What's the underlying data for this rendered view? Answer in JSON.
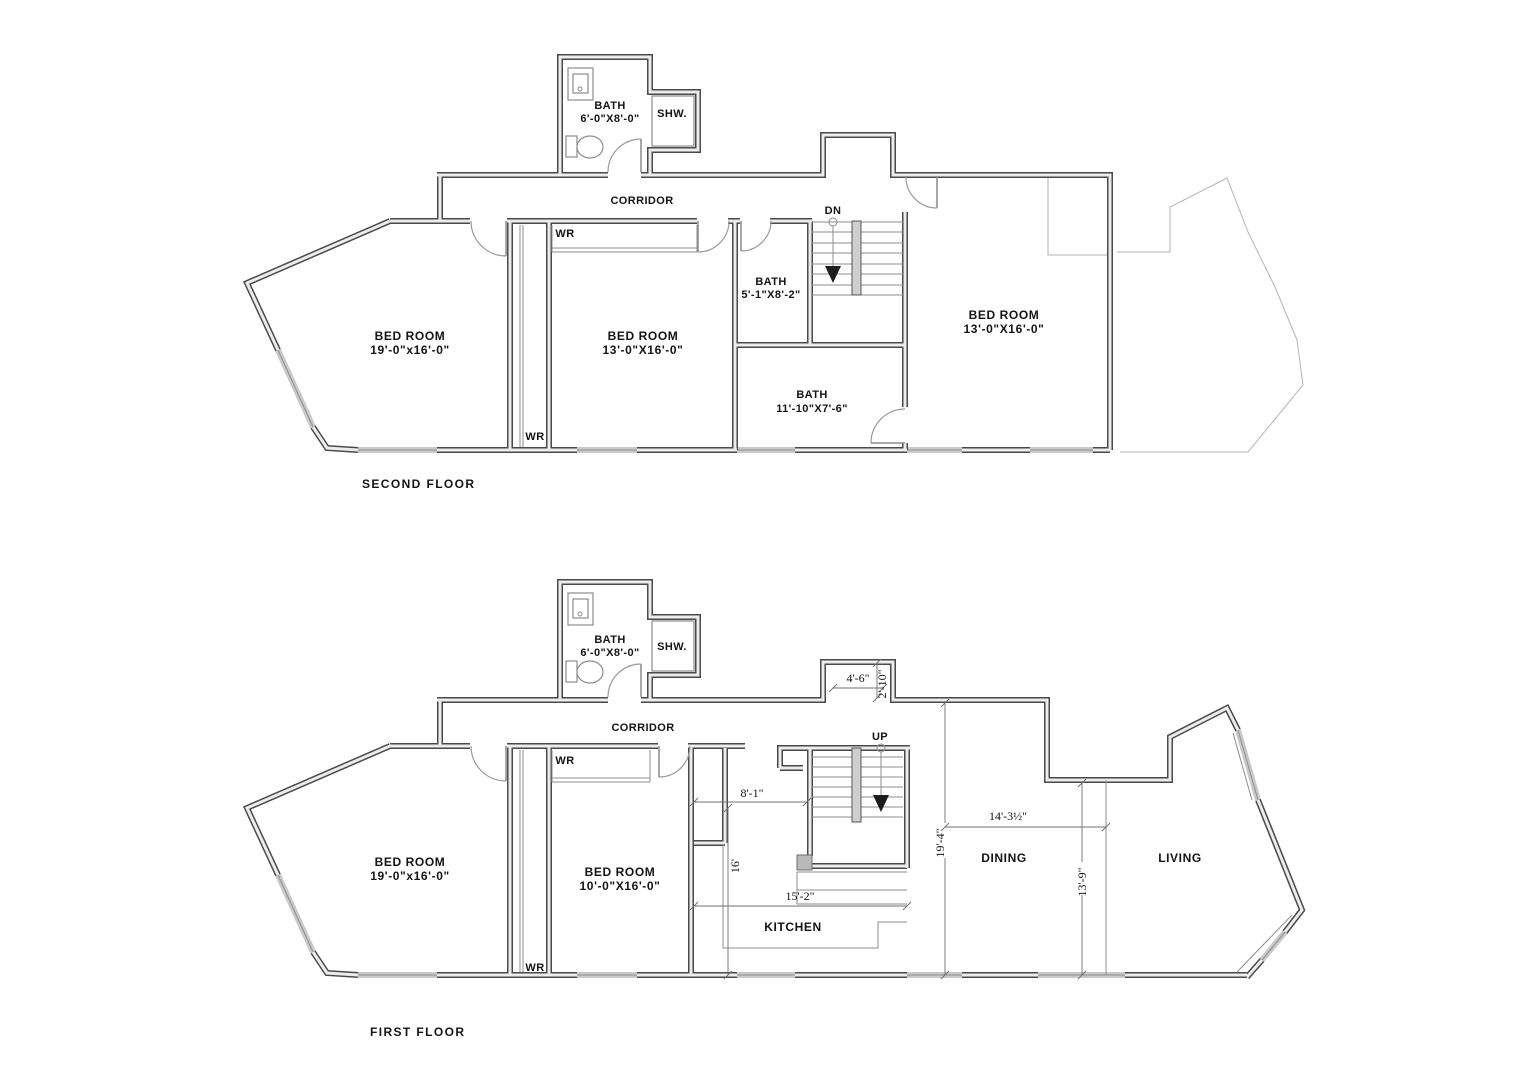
{
  "colors": {
    "bg": "#ffffff",
    "wall_dark": "#4a4a4a",
    "wall_fill": "#ececec",
    "window": "#c9c9c9",
    "text": "#141414"
  },
  "second_floor": {
    "title": "SECOND FLOOR",
    "corridor_label": "CORRIDOR",
    "stairs_label": "DN",
    "rooms": {
      "bath_top": {
        "label": "BATH",
        "dims": "6'-0\"X8'-0\""
      },
      "shower": {
        "label": "SHW."
      },
      "wr_top": {
        "label": "WR"
      },
      "wr_bottom": {
        "label": "WR"
      },
      "bedroom_left": {
        "label": "BED ROOM",
        "dims": "19'-0\"x16'-0\""
      },
      "bedroom_middle": {
        "label": "BED ROOM",
        "dims": "13'-0\"X16'-0\""
      },
      "bedroom_right": {
        "label": "BED ROOM",
        "dims": "13'-0\"X16'-0\""
      },
      "bath_small": {
        "label": "BATH",
        "dims": "5'-1\"X8'-2\""
      },
      "bath_large": {
        "label": "BATH",
        "dims": "11'-10\"X7'-6\""
      }
    }
  },
  "first_floor": {
    "title": "FIRST FLOOR",
    "corridor_label": "CORRIDOR",
    "stairs_label": "UP",
    "rooms": {
      "bath_top": {
        "label": "BATH",
        "dims": "6'-0\"X8'-0\""
      },
      "shower": {
        "label": "SHW."
      },
      "wr_top": {
        "label": "WR"
      },
      "wr_bottom": {
        "label": "WR"
      },
      "bedroom_left": {
        "label": "BED ROOM",
        "dims": "19'-0\"x16'-0\""
      },
      "bedroom_middle": {
        "label": "BED ROOM",
        "dims": "10'-0\"X16'-0\""
      },
      "kitchen": {
        "label": "KITCHEN"
      },
      "dining": {
        "label": "DINING"
      },
      "living": {
        "label": "LIVING"
      }
    },
    "dimensions": {
      "entry_width": "4'-6\"",
      "entry_depth": "2'-10\"",
      "nook_width": "8'-1\"",
      "kitchen_depth": "16'",
      "kitchen_width": "15'-2\"",
      "dining_depth": "19'-4\"",
      "dining_width": "14'-3½\"",
      "living_depth": "13'-9\""
    }
  }
}
